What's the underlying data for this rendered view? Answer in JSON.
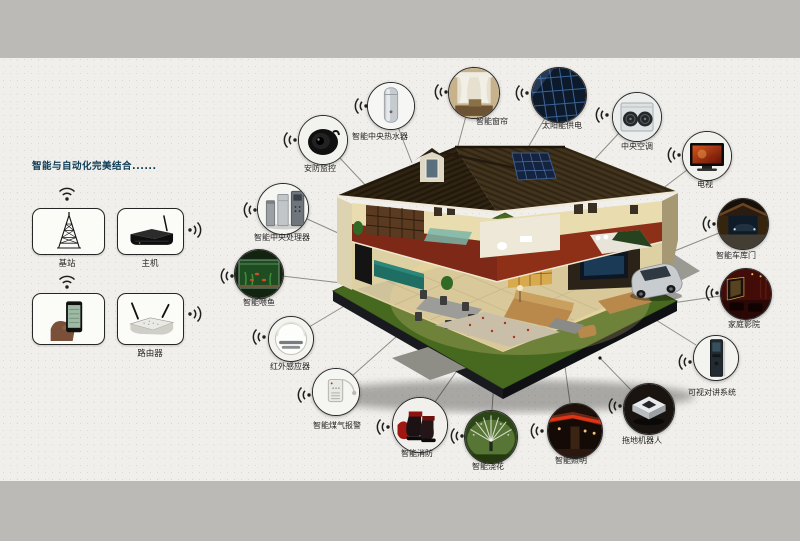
{
  "left_panel": {
    "title": "智能与自动化完美结合......",
    "devices": [
      {
        "id": "base-station",
        "label": "基站"
      },
      {
        "id": "host",
        "label": "主机"
      },
      {
        "id": "smartphone",
        "label": ""
      },
      {
        "id": "router",
        "label": "路由器"
      }
    ]
  },
  "nodes": [
    {
      "id": "security-camera",
      "label": "安防监控"
    },
    {
      "id": "water-heater",
      "label": "智能中央热水器"
    },
    {
      "id": "smart-curtain",
      "label": "智能窗帘"
    },
    {
      "id": "solar-power",
      "label": "太阳能供电"
    },
    {
      "id": "central-ac",
      "label": "中央空调"
    },
    {
      "id": "tv",
      "label": "电视"
    },
    {
      "id": "garage-door",
      "label": "智能车库门"
    },
    {
      "id": "home-theater",
      "label": "家庭影院"
    },
    {
      "id": "video-intercom",
      "label": "可视对讲系统"
    },
    {
      "id": "mopping-robot",
      "label": "拖地机器人"
    },
    {
      "id": "smart-lighting",
      "label": "智能照明"
    },
    {
      "id": "plant-watering",
      "label": "智能浇花"
    },
    {
      "id": "fire-protection",
      "label": "智能消防"
    },
    {
      "id": "gas-alarm",
      "label": "智能煤气报警"
    },
    {
      "id": "infrared-sensor",
      "label": "红外感应器"
    },
    {
      "id": "fish-feeding",
      "label": "智能喂鱼"
    },
    {
      "id": "central-processor",
      "label": "智能中央处理器"
    }
  ],
  "colors": {
    "title_accent": "#0d3b55",
    "band_gray": "#bbbab7",
    "paper": "#f0efeb",
    "lawn_green": "#47691f",
    "roof_brown": "#362a16"
  }
}
